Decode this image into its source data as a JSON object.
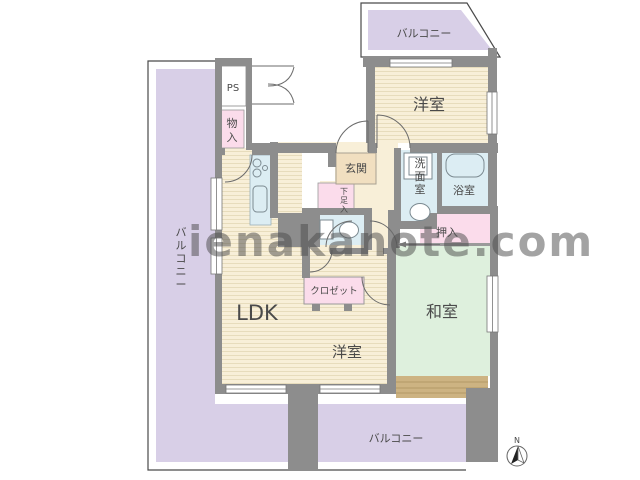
{
  "watermark": {
    "text": "ienakanote.com"
  },
  "compass": {
    "label": "N"
  },
  "rooms": {
    "balcony_top": {
      "label": "バルコニー"
    },
    "balcony_left": {
      "label": "バルコニー",
      "chars": [
        "バ",
        "ル",
        "コ",
        "ニ",
        "ー"
      ]
    },
    "balcony_bottom": {
      "label": "バルコニー"
    },
    "bedroom_top": {
      "label": "洋室"
    },
    "bedroom_bottom": {
      "label": "洋室"
    },
    "washitsu": {
      "label": "和室"
    },
    "ldk": {
      "label": "LDK"
    },
    "genkan": {
      "label": "玄関"
    },
    "senmenshitsu": {
      "label": "洗面室",
      "chars": [
        "洗",
        "面",
        "室"
      ]
    },
    "yokushitsu": {
      "label": "浴室"
    },
    "oshiire": {
      "label": "押入"
    },
    "monoire": {
      "label": "物入",
      "chars": [
        "物",
        "入"
      ]
    },
    "ps": {
      "label": "PS"
    },
    "closet": {
      "label": "クロゼット"
    },
    "getabako": {
      "label": "下足入",
      "chars": [
        "下",
        "足",
        "入"
      ]
    }
  },
  "colors": {
    "wall": "#8d8d8d",
    "balcony": "#d8cfe7",
    "room": "#f8efd8",
    "tatami": "#def0dd",
    "pink": "#fbdceb",
    "blue": "#dcedf3",
    "genkan": "#f1dfc0",
    "wood": "#cdb382",
    "outline": "#4a4a4a",
    "watermark": "#cbcbcb"
  }
}
